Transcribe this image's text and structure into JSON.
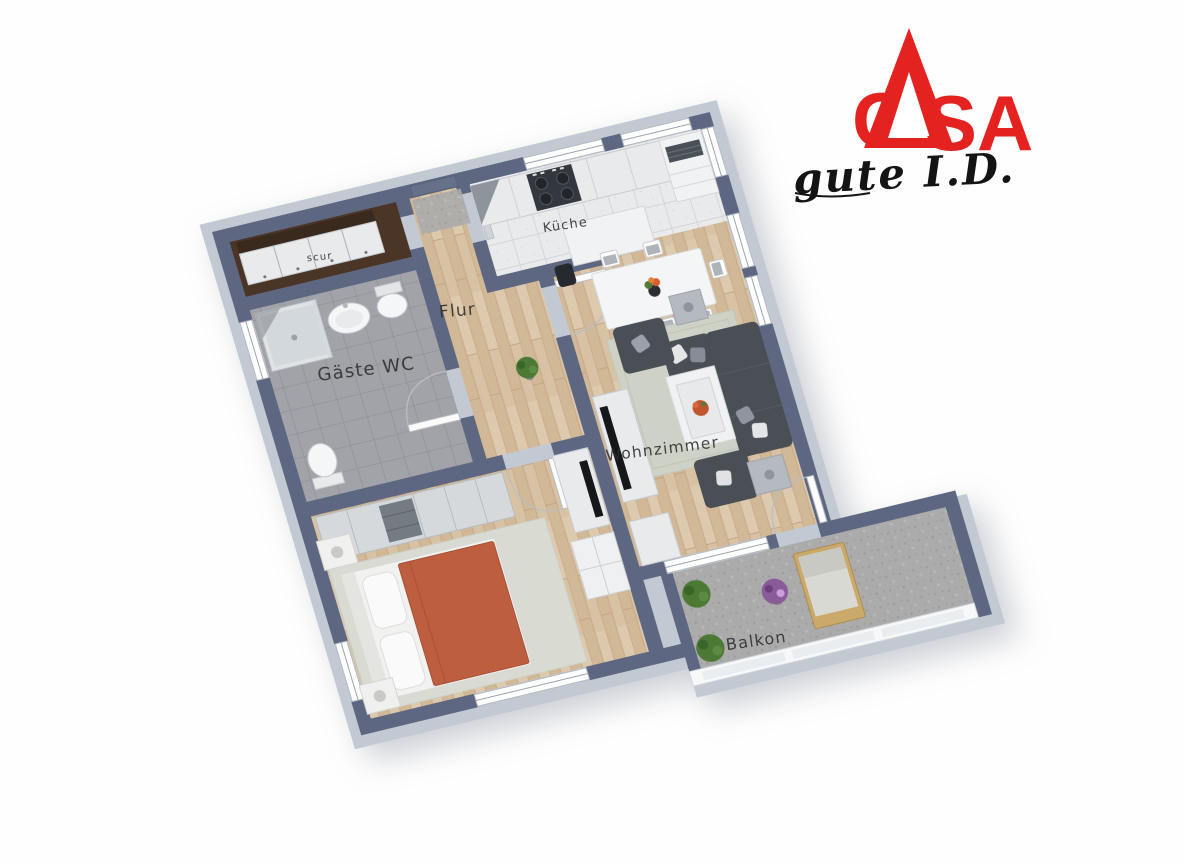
{
  "logo": {
    "brand": "CASA",
    "brand_initial": "C",
    "brand_rest": "SA",
    "tagline": "gute I.D."
  },
  "floorplan": {
    "rooms": [
      {
        "id": "flur",
        "label": "Flur"
      },
      {
        "id": "kueche",
        "label": "Küche"
      },
      {
        "id": "gaeste_wc",
        "label": "Gäste WC"
      },
      {
        "id": "wohnzimmer",
        "label": "Wohnzimmer"
      },
      {
        "id": "balkon",
        "label": "Balkon"
      },
      {
        "id": "entry",
        "label": "scur"
      }
    ]
  },
  "colors": {
    "wall_top": "#5e6781",
    "wall_side": "#c3c9d3",
    "wood_floor": "#d8c2a4",
    "wood_dark": "#c9ae8e",
    "tile_floor": "#e9eaec",
    "wc_floor": "#a2a3a9",
    "balcony_floor": "#ababab",
    "rug_living": "#ced2c6",
    "rug_bedroom": "#d9dbd3",
    "sofa": "#4a4e55",
    "bed_blanket": "#bd5e3f",
    "cabinet_light": "#e8eaec",
    "sideboard_brown": "#4a3526",
    "logo_red": "#e42320",
    "label_ink": "#2d2d2d"
  }
}
